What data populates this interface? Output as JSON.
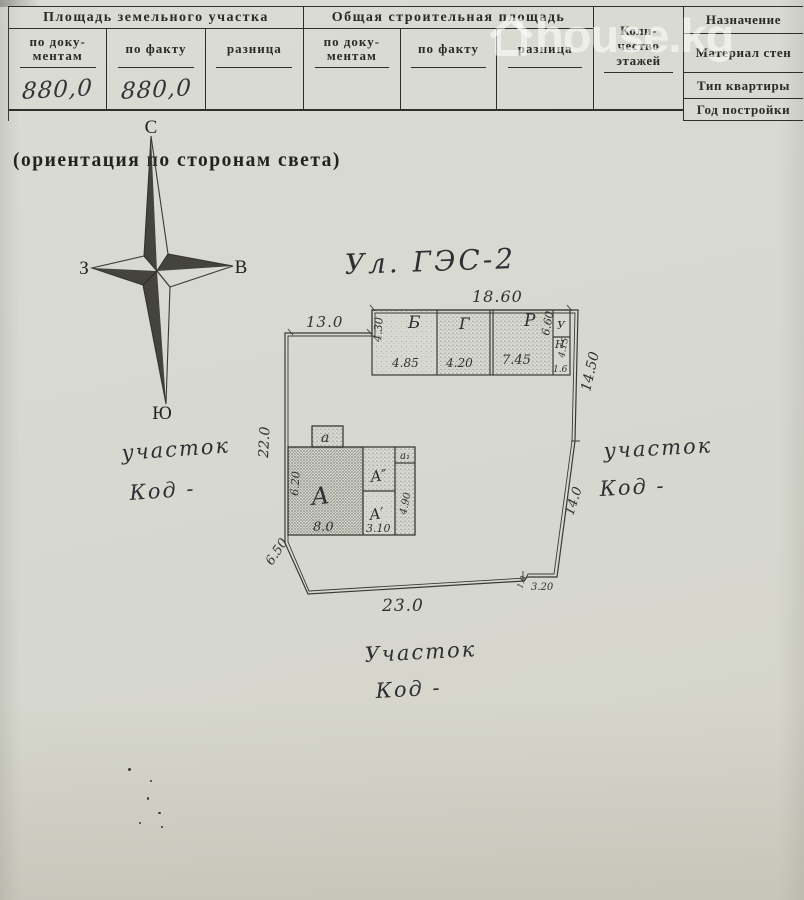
{
  "colors": {
    "paper": "#d7d9d1",
    "ink": "#2f2e2a",
    "plan_line": "#3b3a33",
    "watermark": "rgba(255,255,255,0.55)"
  },
  "watermark": {
    "icon": "house-icon",
    "text": "house.kg"
  },
  "form": {
    "land": {
      "title": "Площадь земельного участка",
      "col1_l1": "по доку-",
      "col1_l2": "ментам",
      "col2": "по факту",
      "col3": "разница",
      "val1": "880,0",
      "val2": "880,0",
      "val3": ""
    },
    "build": {
      "title": "Общая строительная площадь",
      "col1_l1": "по доку-",
      "col1_l2": "ментам",
      "col2": "по факту",
      "col3": "разница",
      "val1": "",
      "val2": "",
      "val3": ""
    },
    "floors_l1": "Коли-",
    "floors_l2": "чество",
    "floors_l3": "этажей",
    "purpose": "Назначение",
    "walls": "Материал стен",
    "apt_type": "Тип квартиры",
    "year": "Год постройки"
  },
  "compass": {
    "n": "С",
    "s": "Ю",
    "w": "З",
    "e": "В",
    "caption": "(ориентация по сторонам света)"
  },
  "plan": {
    "street": "Ул. ГЭС-2",
    "dims": {
      "building_top": "18.60",
      "top_left": "13.0",
      "left_side": "22.0",
      "right_upper": "14.50",
      "right_lower": "14.0",
      "bottom": "23.0",
      "step": "3.20",
      "step_small": "1.0",
      "diagonal": "6.50"
    },
    "outbuilding": {
      "b": "Б",
      "g": "Г",
      "r": "Р",
      "u": "У",
      "n": "Н",
      "b_h": "4.30",
      "b_w": "4.85",
      "g_w": "4.20",
      "r_w": "7.45",
      "r_h": "6.60",
      "n_h": "4.15",
      "n_w": "1.6"
    },
    "house": {
      "a_main": "А",
      "a_prime": "А′",
      "a_dprime": "А″",
      "porch": "а",
      "strip": "а₁",
      "a_h": "6.20",
      "a_w": "8.0",
      "a_prime_w": "3.10",
      "strip_h": "4.90"
    },
    "parcels": {
      "left_l1": "участок",
      "left_l2": "Код -",
      "right_l1": "участок",
      "right_l2": "Код -",
      "bottom_l1": "Участок",
      "bottom_l2": "Код -"
    }
  }
}
